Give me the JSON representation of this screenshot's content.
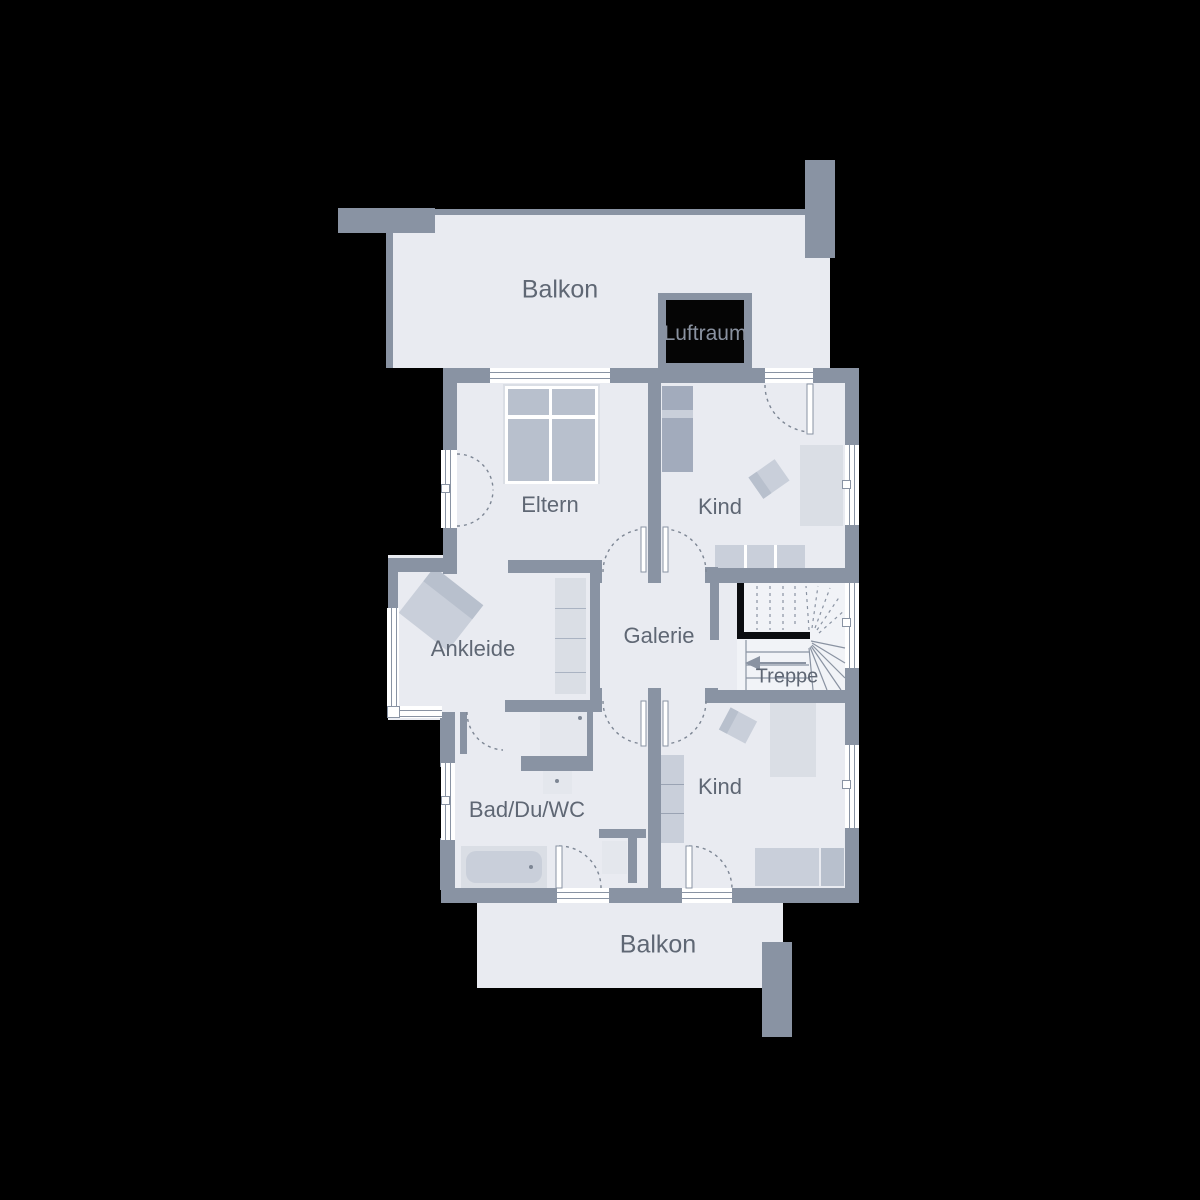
{
  "plan": {
    "type": "floor-plan",
    "rooms": {
      "balcony_top": {
        "label": "Balkon"
      },
      "void": {
        "label": "Luftraum"
      },
      "parents": {
        "label": "Eltern"
      },
      "child_top": {
        "label": "Kind"
      },
      "dressing": {
        "label": "Ankleide"
      },
      "gallery": {
        "label": "Galerie"
      },
      "stairs": {
        "label": "Treppe"
      },
      "bath": {
        "label": "Bad/Du/WC"
      },
      "child_bottom": {
        "label": "Kind"
      },
      "balcony_bottom": {
        "label": "Balkon"
      }
    }
  },
  "palette": {
    "background": "#000000",
    "wall": "#8993a3",
    "floor": "#e9ebf1",
    "stairFloor": "#f1f3f7",
    "furnLight": "#dadee5",
    "furnMed": "#b8c0cd",
    "furnDark": "#a2abbc",
    "furnPale": "#c9cfda",
    "lineColor": "#8993a3",
    "dashColor": "#7d8694",
    "textColor": "#5f6774",
    "handrail": "#0b0d10",
    "windowFill": "#ffffff",
    "voidFill": "#050505"
  }
}
